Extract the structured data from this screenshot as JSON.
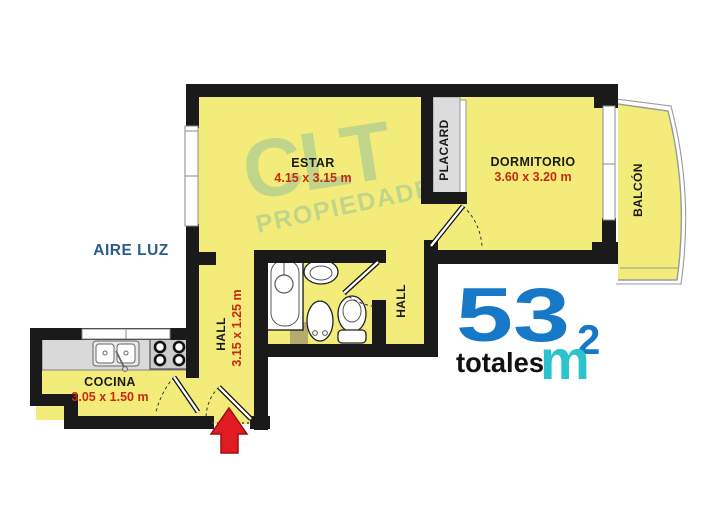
{
  "watermark": {
    "brand": "CLT",
    "sub": "PROPIEDADES"
  },
  "exterior": {
    "aire_luz": "AIRE LUZ",
    "balcon": "BALCÓN"
  },
  "rooms": {
    "estar": {
      "name": "ESTAR",
      "dims": "4.15 x 3.15 m"
    },
    "dormitorio": {
      "name": "DORMITORIO",
      "dims": "3.60 x 3.20 m"
    },
    "placard": {
      "name": "PLACARD"
    },
    "hall_bath": {
      "name": "HALL"
    },
    "hall_entry": {
      "name": "HALL",
      "dims": "3.15 x 1.25 m"
    },
    "cocina": {
      "name": "COCINA",
      "dims": "3.05 x 1.50 m"
    }
  },
  "total": {
    "value": "53",
    "exp": "2",
    "unit": "m",
    "label": "totales"
  },
  "colors": {
    "floor": "#f3ec7a",
    "wall": "#1a1a1a",
    "dims_red": "#c9290f",
    "aire_luz_blue": "#2a5d8c",
    "total_blue": "#1878c8",
    "total_cyan": "#2bc4cd",
    "watermark_green": "#a4c795",
    "arrow_red": "#e11b22"
  }
}
